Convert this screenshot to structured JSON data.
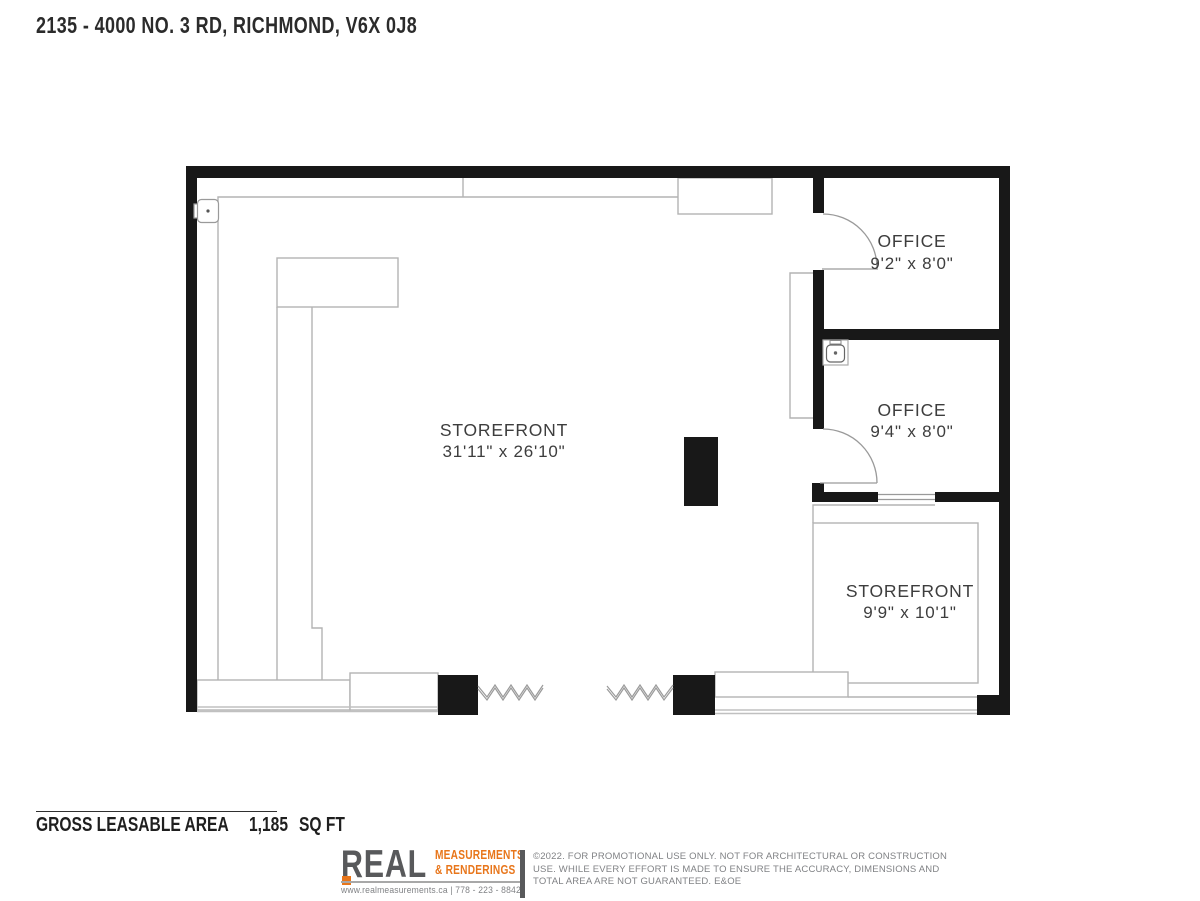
{
  "page": {
    "title": "2135 - 4000 NO. 3 RD, RICHMOND, V6X 0J8"
  },
  "floor_plan": {
    "rooms": [
      {
        "name": "STOREFRONT",
        "dimensions": "31'11\" x 26'10\""
      },
      {
        "name": "OFFICE",
        "dimensions": "9'2\" x 8'0\""
      },
      {
        "name": "OFFICE",
        "dimensions": "9'4\" x 8'0\""
      },
      {
        "name": "STOREFRONT",
        "dimensions": "9'9\" x 10'1\""
      }
    ],
    "icons": [
      "electrical-panel-icon",
      "sink-icon",
      "zigzag-glazing-icon"
    ]
  },
  "summary": {
    "label": "GROSS LEASABLE AREA",
    "value": "1,185",
    "unit": "SQ FT"
  },
  "footer": {
    "brand": "REAL",
    "brand_line1": "MEASUREMENTS",
    "brand_line2": "&  RENDERINGS",
    "contact": "www.realmeasurements.ca  |  778 - 223 - 8842",
    "disclaimer_lines": [
      "©2022. FOR PROMOTIONAL USE ONLY. NOT FOR ARCHITECTURAL OR CONSTRUCTION",
      "USE. WHILE EVERY EFFORT IS MADE TO ENSURE THE ACCURACY, DIMENSIONS AND",
      "TOTAL AREA ARE NOT GUARANTEED. E&OE"
    ],
    "colors": {
      "accent_orange": "#E8761B",
      "brand_gray": "#58595B",
      "text_gray": "#808285",
      "wall_black": "#181818"
    }
  }
}
